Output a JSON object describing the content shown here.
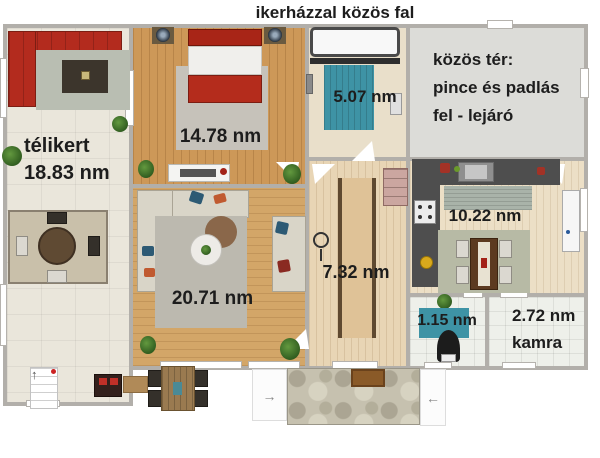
{
  "header": {
    "shared_wall_label": "ikerházzal közös fal"
  },
  "rooms": {
    "winter_garden": {
      "name": "télikert",
      "area": "18.83 nm"
    },
    "bedroom": {
      "area": "14.78 nm"
    },
    "bathroom": {
      "area": "5.07 nm"
    },
    "common_space": {
      "line1": "közös tér:",
      "line2": "pince és padlás",
      "line3": "fel - lejáró"
    },
    "living_room": {
      "area": "20.71 nm"
    },
    "hallway": {
      "area": "7.32 nm"
    },
    "kitchen": {
      "area": "10.22 nm"
    },
    "toilet": {
      "area": "1.15 nm"
    },
    "pantry": {
      "area": "2.72 nm",
      "name": "kamra"
    }
  },
  "icons": {
    "arrow_left": "←",
    "arrow_right": "→",
    "arrow_up": "↑"
  },
  "colors": {
    "wall": "#b2afaa",
    "winter_garden_floor": "#eae6db",
    "bedroom_floor": "#cd9858",
    "living_floor": "#d3a668",
    "hall_floor": "#e8d5b5",
    "kitchen_floor": "#ecdfc6",
    "common_floor": "#dcdcd8",
    "tile_floor": "#eef0ea",
    "accent_teal": "#3e93a5",
    "sofa_red": "#b32b1e",
    "counter_dark": "#4e4e4e",
    "patio_stone": "#c6c1af"
  }
}
